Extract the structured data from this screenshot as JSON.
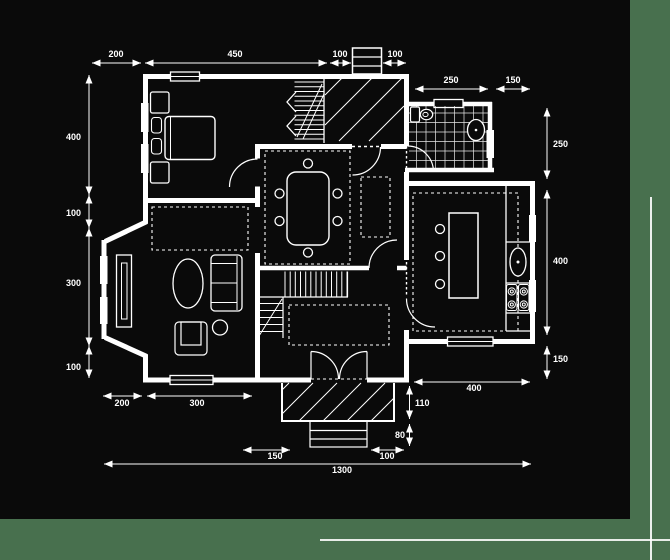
{
  "colors": {
    "background": "#48704E",
    "panel": "#0A0A0A",
    "line": "#FFFFFF"
  },
  "dims": {
    "top": {
      "d200": "200",
      "d450": "450",
      "d100a": "100",
      "d100b": "100"
    },
    "upper_right": {
      "d250": "250",
      "d150": "150"
    },
    "left": {
      "d400": "400",
      "d100a": "100",
      "d300": "300",
      "d100b": "100"
    },
    "right": {
      "d250": "250",
      "d400": "400",
      "d150": "150"
    },
    "bottom_left": {
      "d200": "200",
      "d300": "300"
    },
    "bottom_right": {
      "d400": "400",
      "d110": "110",
      "d80": "80",
      "d100": "100",
      "d150": "150",
      "d1300": "1300"
    }
  }
}
